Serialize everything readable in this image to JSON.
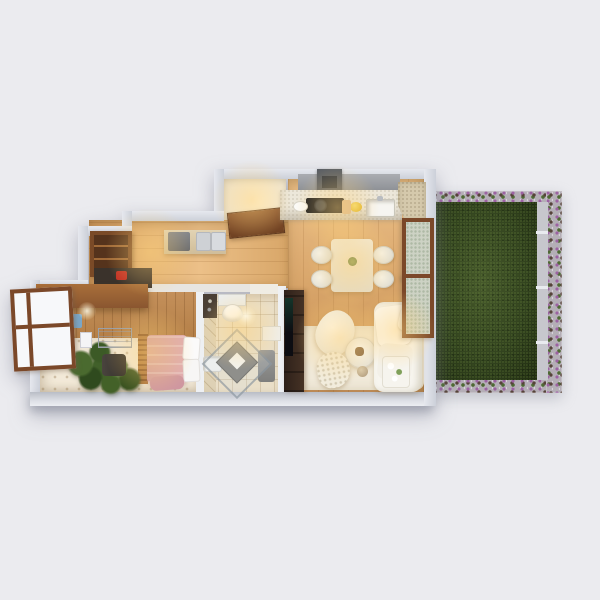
{
  "scene": {
    "type": "3d-floor-plan-render",
    "view": "top-down cutaway",
    "title": "One-bedroom apartment with garden terrace",
    "background_label": "studio backdrop"
  },
  "rooms": [
    {
      "name": "Entry",
      "items": [
        "open front door"
      ]
    },
    {
      "name": "Hallway",
      "items": [
        "wardrobe",
        "shoe cabinet with red shoes",
        "sideboard",
        "coffee machine",
        "storage boxes"
      ]
    },
    {
      "name": "Kitchen",
      "items": [
        "range hood",
        "cooktop with pan",
        "sink",
        "yellow fruit bowl",
        "cutting board",
        "corner counter"
      ]
    },
    {
      "name": "Dining area",
      "items": [
        "dining table",
        "four chairs",
        "green centerpiece"
      ]
    },
    {
      "name": "Living room",
      "items": [
        "white sofa",
        "throw pillows",
        "armchair",
        "round coffee table",
        "shaggy pouf",
        "TV wall unit",
        "cream rug",
        "side table with flowers"
      ]
    },
    {
      "name": "Bedroom",
      "items": [
        "bed with pink bedding",
        "white pillows",
        "slatted headboard",
        "potted plant",
        "open casement window",
        "drying rack",
        "wall lamp",
        "blue towel"
      ]
    },
    {
      "name": "Bathroom",
      "items": [
        "wall-hung toilet",
        "corner glass shower",
        "washbasin",
        "mirror cabinet",
        "laundry unit",
        "shelf"
      ]
    },
    {
      "name": "Garden",
      "items": [
        "lawn",
        "flower border",
        "gravel path",
        "fence posts"
      ]
    }
  ],
  "colors": {
    "bg": "#ebebef",
    "wall-hi": "#e6e8ee",
    "wall-lo": "#ccd0d9",
    "wall-inner": "#eef0f3",
    "wood-hi": "#ecc088",
    "wood-lo": "#d09a5e",
    "wood-wall": "#c5915c",
    "tile-bed": "#f2e9d8",
    "tile-bath": "#eadfc8",
    "rug": "#f0e9d9",
    "lawn-hi": "#46592b",
    "lawn-mid": "#33441f",
    "lawn-lo": "#202c11",
    "gravel": "#b4aeb6",
    "flower-purple": "#9c62a2",
    "flower-green": "#4e6a33",
    "path": "#c7c7cd",
    "frame-brown": "#7b4829",
    "door-brown": "#8a5530",
    "furn-brown": "#8a5630",
    "wardrobe": "#7a4a27",
    "dark-unit": "#463225",
    "pink": "#e0acb3",
    "white-soft": "#f7f5ef",
    "counter": "#ece7da",
    "speckle-beige": "#d5c9ac",
    "hood": "#5a5e64",
    "glow": "#ffd37a"
  }
}
